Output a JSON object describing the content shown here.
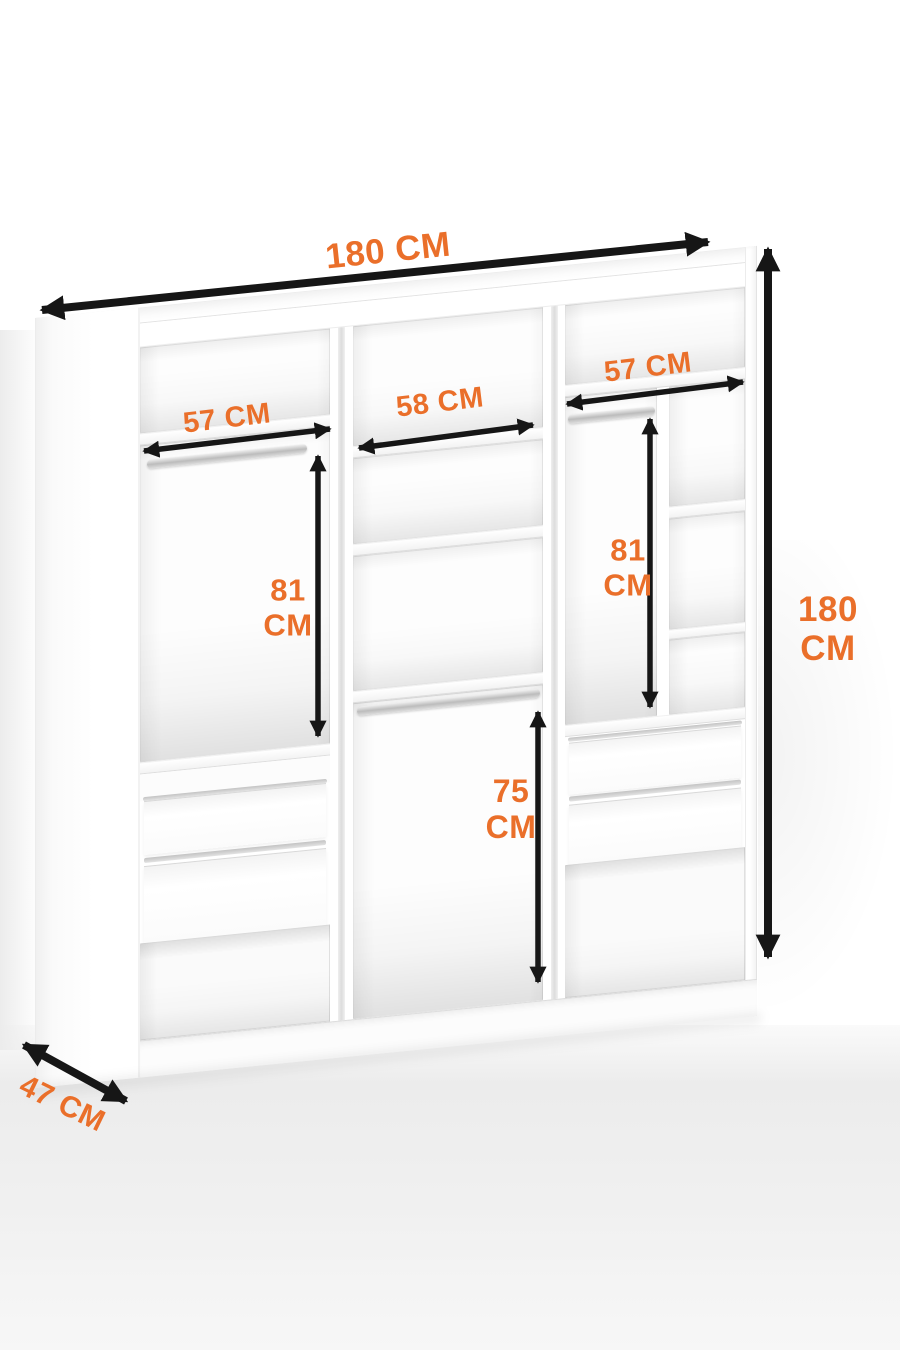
{
  "figure": {
    "type": "wardrobe interior dimension diagram",
    "colors": {
      "accent": "#EA6F2A",
      "arrow": "#161616",
      "furniture": "#FFFFFF"
    }
  },
  "dims": {
    "top_width": {
      "text": "180 CM"
    },
    "height": {
      "value": "180",
      "unit": "CM"
    },
    "depth": {
      "text": "47 CM"
    },
    "left_shelf_width": {
      "text": "57 CM"
    },
    "middle_shelf_width": {
      "text": "58 CM"
    },
    "right_shelf_width": {
      "text": "57 CM"
    },
    "left_hanging_height": {
      "value": "81",
      "unit": "CM"
    },
    "right_hanging_height": {
      "value": "81",
      "unit": "CM"
    },
    "center_hanging_height": {
      "value": "75",
      "unit": "CM"
    }
  }
}
